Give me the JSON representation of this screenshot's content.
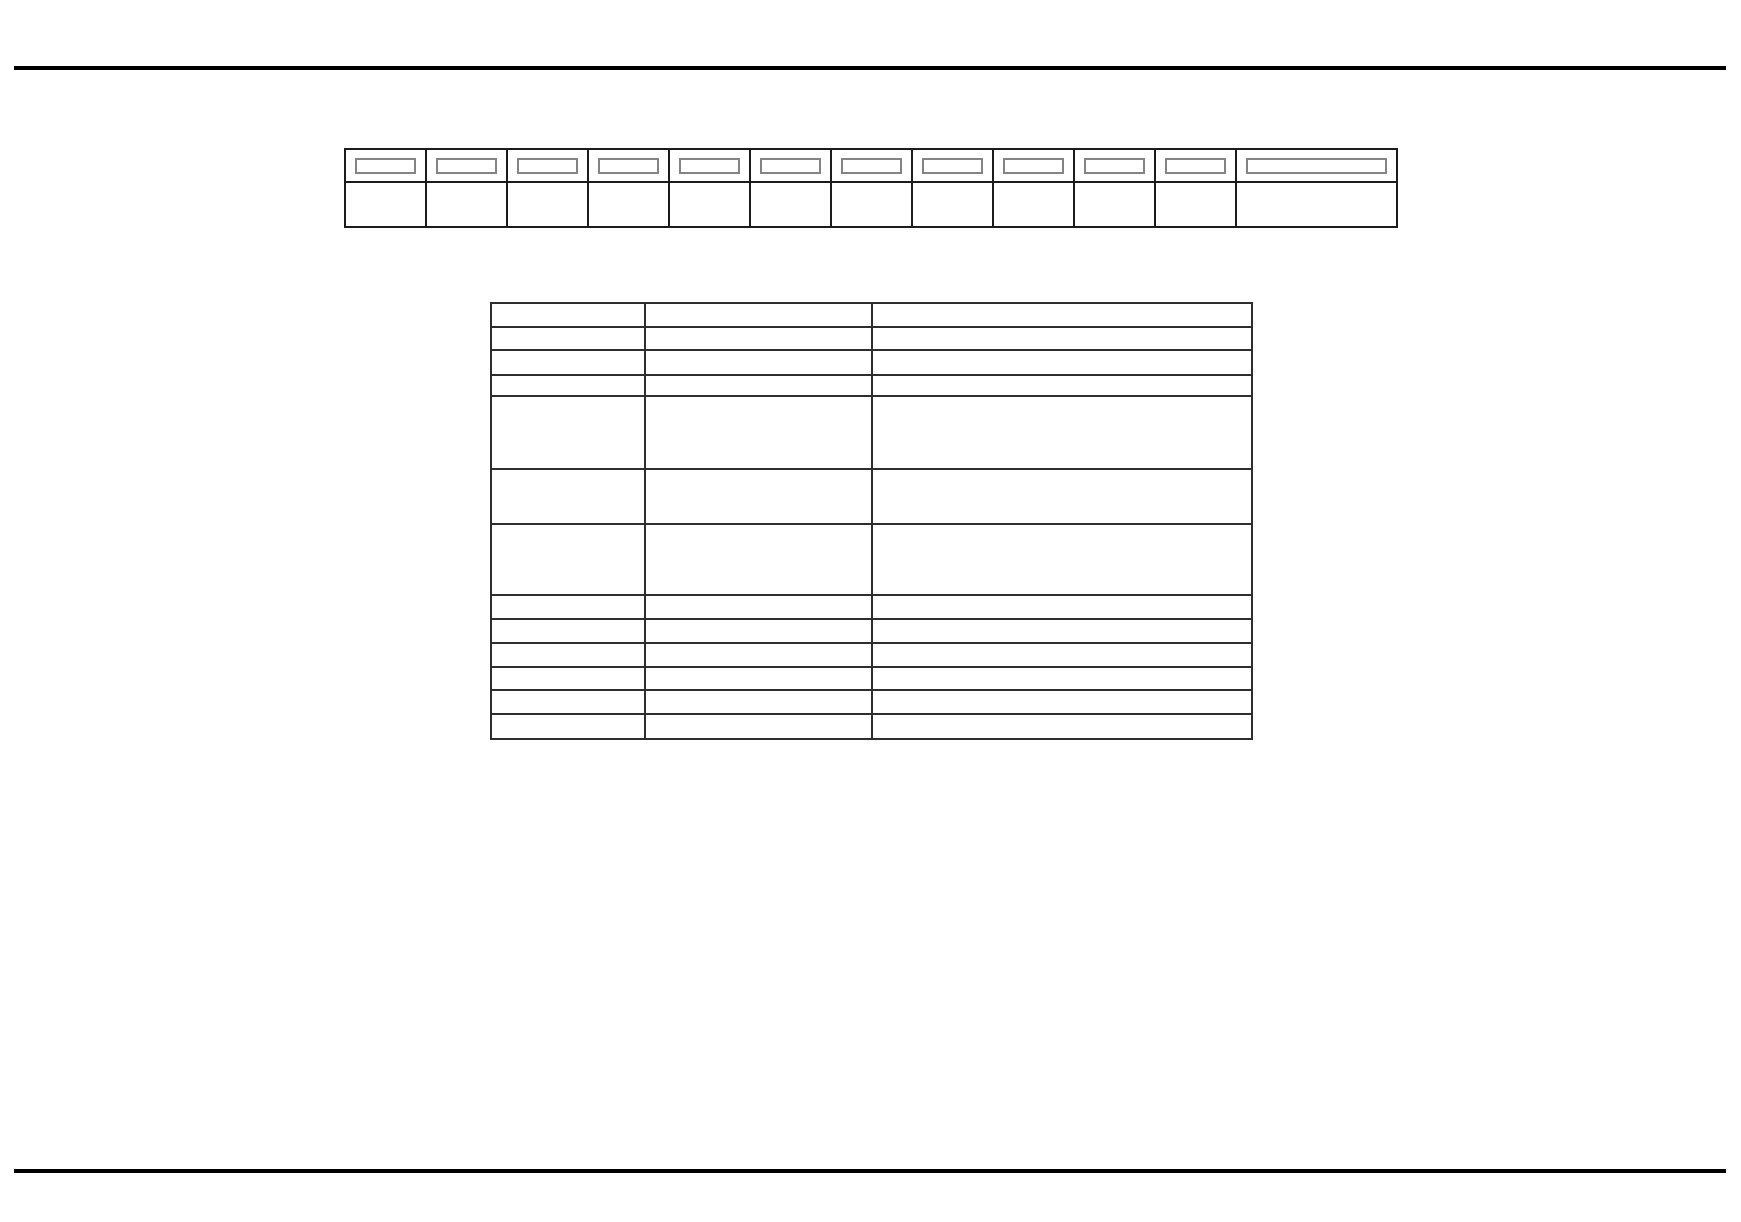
{
  "page": {
    "background_color": "#ffffff",
    "rule_color": "#000000",
    "rules": [
      {
        "name": "top-rule",
        "x": 14,
        "y": 66,
        "width": 1712,
        "height": 4
      },
      {
        "name": "bottom-rule",
        "x": 14,
        "y": 1169,
        "width": 1712,
        "height": 4
      }
    ]
  },
  "header_fields_table": {
    "border_color": "#1c1c1c",
    "field_box_border_color": "#848484",
    "column_widths_px": [
      81,
      81,
      81,
      81,
      81,
      81,
      81,
      81,
      81,
      81,
      81,
      161
    ],
    "header_row_height_px": 35,
    "body_row_height_px": 47,
    "rows": [
      {
        "type": "header",
        "cells": [
          "",
          "",
          "",
          "",
          "",
          "",
          "",
          "",
          "",
          "",
          "",
          ""
        ]
      },
      {
        "type": "body",
        "cells": [
          "",
          "",
          "",
          "",
          "",
          "",
          "",
          "",
          "",
          "",
          "",
          ""
        ]
      }
    ]
  },
  "details_table": {
    "border_color": "#2e2e2e",
    "column_widths_px": [
      154,
      227,
      380
    ],
    "row_heights_px": [
      24,
      23,
      25,
      21,
      73,
      55,
      71,
      24,
      24,
      24,
      23,
      24,
      25
    ],
    "rows": [
      [
        "",
        "",
        ""
      ],
      [
        "",
        "",
        ""
      ],
      [
        "",
        "",
        ""
      ],
      [
        "",
        "",
        ""
      ],
      [
        "",
        "",
        ""
      ],
      [
        "",
        "",
        ""
      ],
      [
        "",
        "",
        ""
      ],
      [
        "",
        "",
        ""
      ],
      [
        "",
        "",
        ""
      ],
      [
        "",
        "",
        ""
      ],
      [
        "",
        "",
        ""
      ],
      [
        "",
        "",
        ""
      ],
      [
        "",
        "",
        ""
      ]
    ]
  }
}
